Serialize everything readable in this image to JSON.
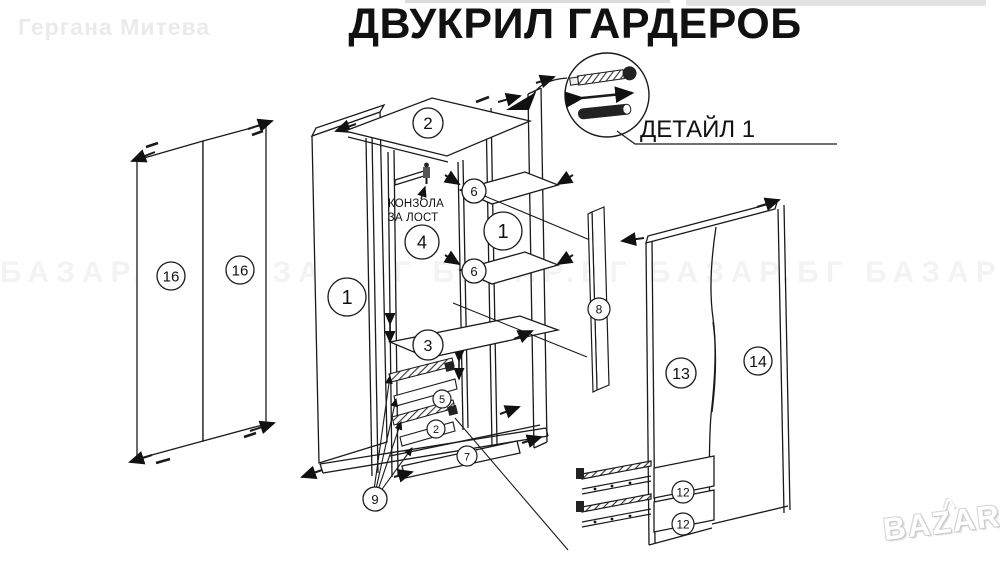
{
  "title": "ДВУКРИЛ ГАРДЕРОБ",
  "watermarks": {
    "top_left": "Гергана Митева",
    "band": "БАЗАР.БГ   БАЗАР.БГ   БАЗАР.БГ   БАЗАР.БГ   БАЗАР.БГ",
    "logo_text": "BAZAR",
    "logo_caret": "^"
  },
  "labels": {
    "detail": "ДЕТАЙЛ 1",
    "rod_line1": "КОНЗОЛА",
    "rod_line2": "ЗА ЛОСТ"
  },
  "parts": {
    "p1": "1",
    "p2": "2",
    "p3": "3",
    "p4": "4",
    "p5": "5",
    "p6": "6",
    "p7": "7",
    "p8": "8",
    "p9": "9",
    "p12": "12",
    "p13": "13",
    "p14": "14",
    "p16": "16"
  },
  "colors": {
    "line": "#1a1a1a",
    "watermark": "#ebebeb",
    "background": "#ffffff"
  }
}
